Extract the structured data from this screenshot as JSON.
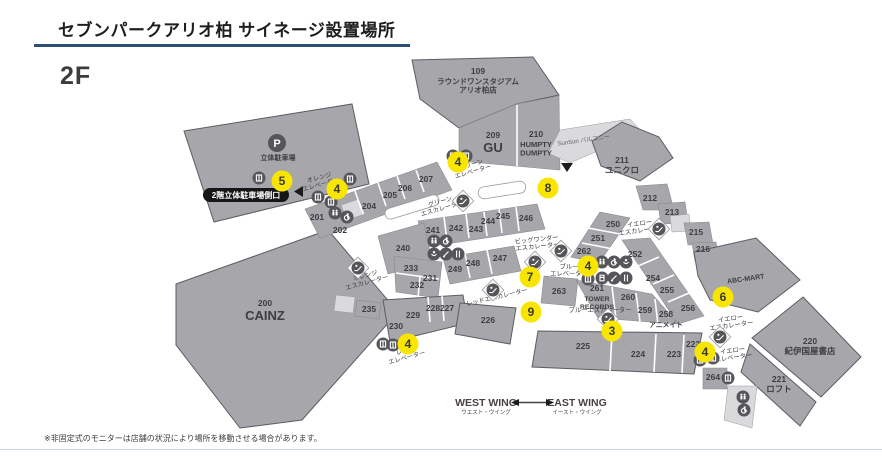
{
  "header": {
    "title": "セブンパークアリオ柏 サイネージ設置場所",
    "floor": "2F"
  },
  "footer": {
    "note": "※非固定式のモニターは店舗の状況により場所を移動させる場合があります。"
  },
  "legend": {
    "west": "WEST WING",
    "west_jp": "ウエスト・ウイング",
    "east": "EAST WING",
    "east_jp": "イースト・ウイング"
  },
  "colors": {
    "accent": "#2c4f74",
    "building": "#a7a7ab",
    "building_light": "#dadadc",
    "signage_yellow": "#f8e600",
    "icon_gray": "#55555a",
    "badge_black": "#161616"
  },
  "map": {
    "texts": {
      "abc_mart": "ABC-MART",
      "balcony": "SunSun バルコニー",
      "parking": "立体駐車場",
      "parking_p": "P",
      "parking_badge": "2階立体駐車場側口"
    },
    "areas": [
      {
        "id": "109",
        "name": "ラウンドワンスタジアム\nアリオ柏店",
        "ns": 7.5,
        "x": 478,
        "y": 71
      },
      {
        "id": "200",
        "name": "CAINZ",
        "ns": 13,
        "x": 265,
        "y": 303
      },
      {
        "id": "201",
        "x": 317,
        "y": 217
      },
      {
        "id": "202",
        "x": 340,
        "y": 230
      },
      {
        "id": "204",
        "x": 369,
        "y": 206
      },
      {
        "id": "205",
        "x": 390,
        "y": 195
      },
      {
        "id": "206",
        "x": 405,
        "y": 188
      },
      {
        "id": "207",
        "x": 426,
        "y": 179
      },
      {
        "id": "209",
        "name": "GU",
        "ns": 13,
        "x": 493,
        "y": 135
      },
      {
        "id": "210",
        "name": "HUMPTY\nDUMPTY",
        "ns": 7.5,
        "x": 536,
        "y": 134
      },
      {
        "id": "211",
        "name": "ユニクロ",
        "ns": 8.5,
        "x": 622,
        "y": 160
      },
      {
        "id": "212",
        "x": 650,
        "y": 198
      },
      {
        "id": "213",
        "x": 672,
        "y": 212
      },
      {
        "id": "215",
        "x": 696,
        "y": 232
      },
      {
        "id": "216",
        "x": 703,
        "y": 249
      },
      {
        "id": "220",
        "name": "紀伊国屋書店",
        "ns": 8.5,
        "x": 810,
        "y": 341
      },
      {
        "id": "221",
        "name": "ロフト",
        "ns": 8.5,
        "x": 779,
        "y": 379
      },
      {
        "id": "222",
        "x": 693,
        "y": 344
      },
      {
        "id": "223",
        "x": 674,
        "y": 354
      },
      {
        "id": "224",
        "x": 638,
        "y": 354
      },
      {
        "id": "225",
        "x": 583,
        "y": 346
      },
      {
        "id": "226",
        "x": 488,
        "y": 320
      },
      {
        "id": "227",
        "x": 447,
        "y": 308
      },
      {
        "id": "228",
        "x": 433,
        "y": 308
      },
      {
        "id": "229",
        "x": 413,
        "y": 315
      },
      {
        "id": "230",
        "x": 396,
        "y": 326
      },
      {
        "id": "231",
        "x": 430,
        "y": 278
      },
      {
        "id": "232",
        "x": 417,
        "y": 285
      },
      {
        "id": "233",
        "x": 411,
        "y": 268
      },
      {
        "id": "235",
        "x": 369,
        "y": 309
      },
      {
        "id": "240",
        "x": 403,
        "y": 248
      },
      {
        "id": "241",
        "x": 433,
        "y": 230
      },
      {
        "id": "242",
        "x": 456,
        "y": 228
      },
      {
        "id": "243",
        "x": 476,
        "y": 229
      },
      {
        "id": "244",
        "x": 488,
        "y": 221
      },
      {
        "id": "245",
        "x": 503,
        "y": 216
      },
      {
        "id": "246",
        "x": 526,
        "y": 218
      },
      {
        "id": "247",
        "x": 500,
        "y": 258
      },
      {
        "id": "248",
        "x": 473,
        "y": 263
      },
      {
        "id": "249",
        "x": 455,
        "y": 269
      },
      {
        "id": "250",
        "x": 613,
        "y": 224
      },
      {
        "id": "251",
        "x": 598,
        "y": 238
      },
      {
        "id": "252",
        "x": 635,
        "y": 254
      },
      {
        "id": "254",
        "x": 653,
        "y": 278
      },
      {
        "id": "255",
        "x": 667,
        "y": 290
      },
      {
        "id": "256",
        "x": 688,
        "y": 308
      },
      {
        "id": "258",
        "name": "アニメイト",
        "ns": 6.8,
        "x": 666,
        "y": 314
      },
      {
        "id": "259",
        "x": 645,
        "y": 310
      },
      {
        "id": "260",
        "x": 628,
        "y": 297
      },
      {
        "id": "261",
        "name": "TOWER\nRECORDS",
        "ns": 6.8,
        "x": 597,
        "y": 288
      },
      {
        "id": "262",
        "x": 584,
        "y": 251
      },
      {
        "id": "263",
        "x": 559,
        "y": 291
      },
      {
        "id": "264",
        "x": 713,
        "y": 377
      }
    ],
    "facilities": [
      {
        "key": "green-escalator",
        "label": "グリーン\nエスカレーター",
        "x": 441,
        "y": 205,
        "rot": -16
      },
      {
        "key": "green-elevator",
        "label": "グリーン\nエレベーター",
        "x": 472,
        "y": 168,
        "rot": -16
      },
      {
        "key": "orange-escalator",
        "label": "オレンジ\nエスカレーター",
        "x": 366,
        "y": 279,
        "rot": -15
      },
      {
        "key": "orange-elevator",
        "label": "オレンジ\nエレベーター",
        "x": 320,
        "y": 181,
        "rot": -15
      },
      {
        "key": "red-escalator",
        "label": "レッドエスカレーター",
        "x": 497,
        "y": 297,
        "rot": -13
      },
      {
        "key": "red-elevator",
        "label": "レッド\nエレベーター",
        "x": 406,
        "y": 354,
        "rot": -15
      },
      {
        "key": "blue-escalator",
        "label": "ブルーエスカレーター",
        "x": 600,
        "y": 310,
        "rot": 0
      },
      {
        "key": "blue-elevator",
        "label": "ブルー\nエレベーター",
        "x": 569,
        "y": 270,
        "rot": 0
      },
      {
        "key": "big-wonder-escalator",
        "label": "ビッグワンダー\nエスカレーター",
        "x": 537,
        "y": 243,
        "rot": -6
      },
      {
        "key": "yellow-escalator-upper",
        "label": "イエロー\nエスカレーター",
        "x": 640,
        "y": 227,
        "rot": -8
      },
      {
        "key": "yellow-escalator-lower",
        "label": "イエロー\nエスカレーター",
        "x": 731,
        "y": 322,
        "rot": -8
      },
      {
        "key": "yellow-elevator",
        "label": "イエロー\nエレベーター",
        "x": 733,
        "y": 354,
        "rot": -8
      }
    ],
    "signage": [
      {
        "num": "5",
        "x": 282,
        "y": 181
      },
      {
        "num": "4",
        "x": 337,
        "y": 189
      },
      {
        "num": "4",
        "x": 458,
        "y": 162
      },
      {
        "num": "8",
        "x": 548,
        "y": 188
      },
      {
        "num": "4",
        "x": 588,
        "y": 266
      },
      {
        "num": "7",
        "x": 530,
        "y": 277
      },
      {
        "num": "6",
        "x": 723,
        "y": 297
      },
      {
        "num": "9",
        "x": 531,
        "y": 312
      },
      {
        "num": "3",
        "x": 612,
        "y": 331
      },
      {
        "num": "4",
        "x": 408,
        "y": 344
      },
      {
        "num": "4",
        "x": 705,
        "y": 352
      }
    ],
    "icons": [
      {
        "type": "elevator",
        "x": 259,
        "y": 178
      },
      {
        "type": "elevator",
        "x": 350,
        "y": 179
      },
      {
        "type": "elevator",
        "x": 318,
        "y": 197
      },
      {
        "type": "elevator",
        "x": 331,
        "y": 202
      },
      {
        "type": "restroom",
        "x": 335,
        "y": 213
      },
      {
        "type": "wheelchair",
        "x": 347,
        "y": 217
      },
      {
        "type": "escalator",
        "x": 358,
        "y": 268,
        "pad": true
      },
      {
        "type": "escalator",
        "x": 463,
        "y": 201,
        "pad": true
      },
      {
        "type": "elevator",
        "x": 453,
        "y": 156
      },
      {
        "type": "elevator",
        "x": 466,
        "y": 156
      },
      {
        "type": "restroom",
        "x": 434,
        "y": 241
      },
      {
        "type": "wheelchair",
        "x": 446,
        "y": 241
      },
      {
        "type": "baby",
        "x": 434,
        "y": 254
      },
      {
        "type": "pen",
        "x": 446,
        "y": 254
      },
      {
        "type": "food",
        "x": 458,
        "y": 254
      },
      {
        "type": "escalator",
        "x": 493,
        "y": 290,
        "pad": true
      },
      {
        "type": "elevator",
        "x": 383,
        "y": 344
      },
      {
        "type": "elevator",
        "x": 393,
        "y": 345
      },
      {
        "type": "escalator",
        "x": 659,
        "y": 229,
        "pad": true
      },
      {
        "type": "escalator",
        "x": 535,
        "y": 262,
        "pad": true
      },
      {
        "type": "escalator",
        "x": 561,
        "y": 251,
        "pad": true
      },
      {
        "type": "elevator",
        "x": 588,
        "y": 279
      },
      {
        "type": "restroom",
        "x": 602,
        "y": 262
      },
      {
        "type": "wheelchair",
        "x": 614,
        "y": 262
      },
      {
        "type": "baby",
        "x": 626,
        "y": 262
      },
      {
        "type": "vending",
        "x": 602,
        "y": 278
      },
      {
        "type": "pen",
        "x": 614,
        "y": 278
      },
      {
        "type": "food",
        "x": 626,
        "y": 278
      },
      {
        "type": "escalator",
        "x": 608,
        "y": 319,
        "pad": true
      },
      {
        "type": "escalator",
        "x": 720,
        "y": 337,
        "pad": true
      },
      {
        "type": "elevator",
        "x": 700,
        "y": 360
      },
      {
        "type": "elevator",
        "x": 713,
        "y": 358
      },
      {
        "type": "elevator",
        "x": 728,
        "y": 378
      },
      {
        "type": "restroom",
        "x": 743,
        "y": 397
      },
      {
        "type": "wheelchair",
        "x": 744,
        "y": 410
      }
    ]
  }
}
